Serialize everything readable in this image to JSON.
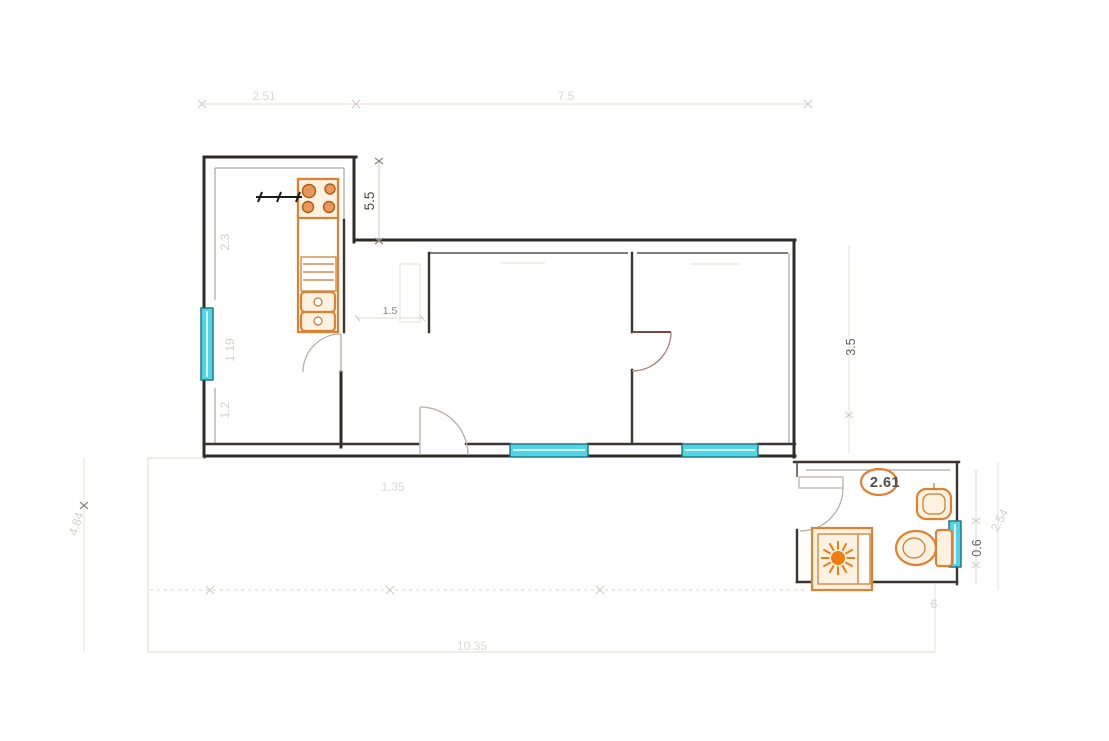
{
  "title": "apartment-floor-plan",
  "dimensions": {
    "top_left_width": "2.51",
    "top_right_width": "7.5",
    "kitchen_depth": "5.5",
    "kitchen_upper_wall": "2.3",
    "kitchen_window_span": "1.19",
    "kitchen_lower_wall": "1.2",
    "kitchen_door_width": "1.5",
    "terrace_left_height": "4.84",
    "right_wall_height": "3.5",
    "bathroom_width": "2.61",
    "bathroom_window": "0.6",
    "bathroom_height": "2.54",
    "bathroom_small_mark": "6",
    "terrace_inner": "1.35",
    "bottom_total_width": "10.35"
  },
  "colors": {
    "wall": "#2f2b27",
    "window_fill": "#4fd6e6",
    "window_border": "#20707e",
    "fixture_orange": "#dd8233",
    "fixture_fill": "#fdf2e2",
    "shower_burst": "#ee7d15",
    "door_arc": "#b8aea5",
    "dim_dark": "#4a453e",
    "dim_faint": "#d5d0c7"
  },
  "fixtures": {
    "kitchen": [
      "stove-4-burner",
      "kitchen-counter-column",
      "built-in-appliance",
      "double-sink"
    ],
    "bathroom": [
      "washbasin-oval",
      "hand-sink",
      "toilet-with-tank",
      "shower-tray-sunburst"
    ],
    "window_count": "4",
    "door_count": "4"
  }
}
